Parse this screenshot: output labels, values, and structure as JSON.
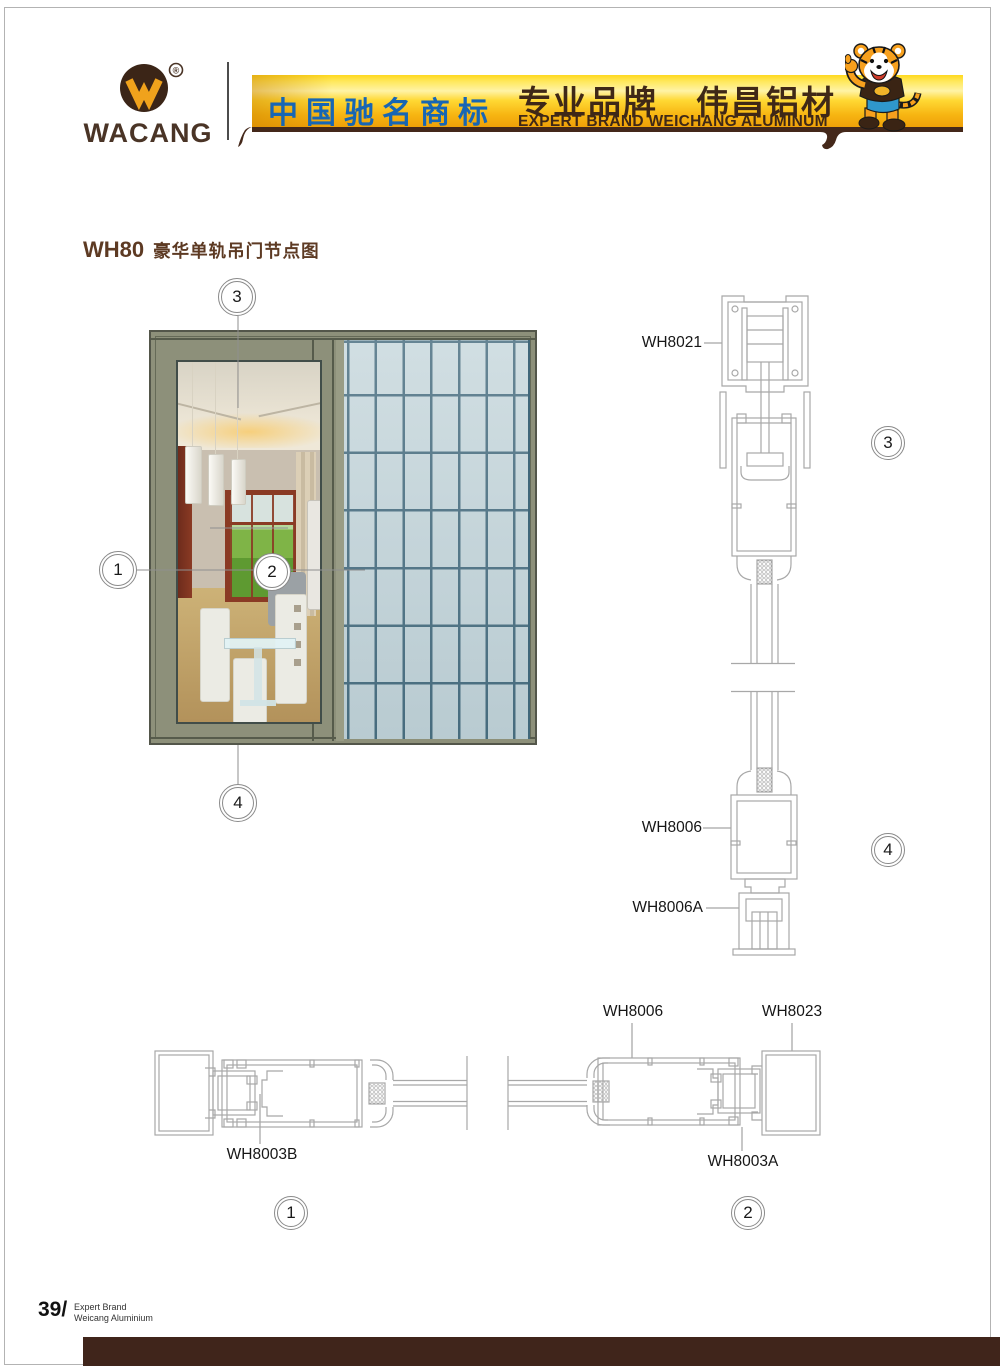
{
  "header": {
    "logo": {
      "monogram": "W",
      "registered": "®",
      "brand": "WACANG"
    },
    "banner": {
      "headline_cn": "中国驰名商标",
      "brand_cn_a": "专业品牌",
      "brand_cn_b": "伟昌铝材",
      "subline_en": "EXPERT BRAND WEICHANG ALUMINUM"
    },
    "mascot": "tiger-mascot"
  },
  "title": {
    "series": "WH80",
    "name": "豪华单轨吊门节点图"
  },
  "callouts": {
    "c1": "1",
    "c2": "2",
    "c3": "3",
    "c4": "4"
  },
  "labels": {
    "track": "WH8021",
    "bottom_rail": "WH8006",
    "floor_guide": "WH8006A",
    "plan_stile": "WH8006",
    "plan_jamb": "WH8023",
    "pocket": "WH8003B",
    "interlock": "WH8003A"
  },
  "footer": {
    "page_number": "39/",
    "brand_line1": "Expert Brand",
    "brand_line2": "Weicang Aluminium"
  },
  "colors": {
    "banner_blue": "#1766b4",
    "banner_brown": "#3f2817",
    "banner_gold": "#f5b40d",
    "logo_brown": "#3b2517",
    "title_brown": "#5d3a23",
    "frame_olive": "#8d907a",
    "grid_line": "#40677a",
    "grid_tile": "#c5d6db",
    "drawing_line": "#a8a8a8",
    "footer_bar": "#40251b"
  }
}
